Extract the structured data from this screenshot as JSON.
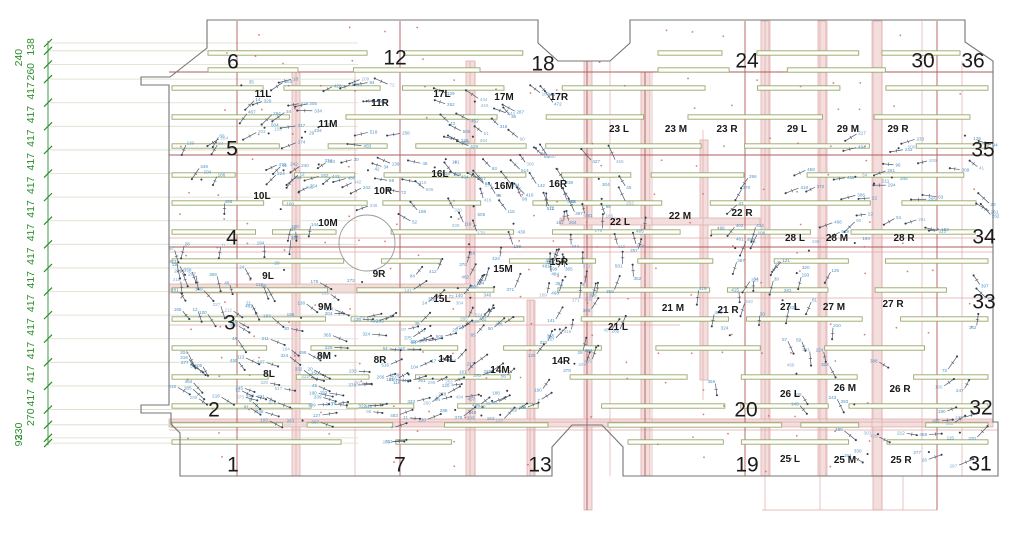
{
  "canvas": {
    "width": 1024,
    "height": 541,
    "background": "#ffffff"
  },
  "colors": {
    "outline": "#757575",
    "outline_light": "#9a9a9a",
    "grid_major": "#b25b5b",
    "grid_minor": "#e2aaaa",
    "band_fill": "#f3dddd",
    "band_edge": "#dca6a6",
    "beam_edge": "#9aa76b",
    "beam_fill": "#fdfefa",
    "dim_green": "#2f8f2f",
    "dim_extension": "#d8dec8",
    "point_line": "#4e596b",
    "point_dot": "#333f4e",
    "point_value": "#4f93c6",
    "point_value_alt": "#85afd3",
    "red_dot": "#d05f5f",
    "label_black": "#1a1a1a",
    "circle": "#9a9a9a"
  },
  "dimension_chain": {
    "axis_x": 48,
    "top_y": 43,
    "scale": 0.0566,
    "label_x": 34,
    "ext_x2": 358,
    "values": [
      "138",
      "240",
      "260",
      "417",
      "417",
      "417",
      "417",
      "417",
      "417",
      "417",
      "417",
      "417",
      "417",
      "417",
      "417",
      "417",
      "417",
      "270",
      "230",
      "93"
    ]
  },
  "grid_numbers": [
    {
      "t": "6",
      "x": 233,
      "y": 63
    },
    {
      "t": "12",
      "x": 395,
      "y": 59
    },
    {
      "t": "18",
      "x": 543,
      "y": 65
    },
    {
      "t": "24",
      "x": 747,
      "y": 62
    },
    {
      "t": "30",
      "x": 923,
      "y": 62
    },
    {
      "t": "36",
      "x": 973,
      "y": 62
    },
    {
      "t": "5",
      "x": 232,
      "y": 150
    },
    {
      "t": "35",
      "x": 983,
      "y": 151
    },
    {
      "t": "4",
      "x": 232,
      "y": 239
    },
    {
      "t": "34",
      "x": 984,
      "y": 238
    },
    {
      "t": "3",
      "x": 230,
      "y": 324
    },
    {
      "t": "33",
      "x": 984,
      "y": 303
    },
    {
      "t": "2",
      "x": 214,
      "y": 411
    },
    {
      "t": "20",
      "x": 746,
      "y": 411
    },
    {
      "t": "32",
      "x": 981,
      "y": 409
    },
    {
      "t": "1",
      "x": 233,
      "y": 466
    },
    {
      "t": "7",
      "x": 400,
      "y": 466
    },
    {
      "t": "13",
      "x": 540,
      "y": 466
    },
    {
      "t": "19",
      "x": 747,
      "y": 466
    },
    {
      "t": "31",
      "x": 980,
      "y": 465
    }
  ],
  "zone_labels": [
    {
      "t": "11L",
      "x": 263,
      "y": 97
    },
    {
      "t": "11M",
      "x": 328,
      "y": 127
    },
    {
      "t": "11R",
      "x": 380,
      "y": 106
    },
    {
      "t": "17L",
      "x": 442,
      "y": 97
    },
    {
      "t": "17M",
      "x": 504,
      "y": 100
    },
    {
      "t": "17R",
      "x": 559,
      "y": 100
    },
    {
      "t": "23 L",
      "x": 619,
      "y": 132
    },
    {
      "t": "23 M",
      "x": 676,
      "y": 132
    },
    {
      "t": "23 R",
      "x": 727,
      "y": 132
    },
    {
      "t": "29 L",
      "x": 797,
      "y": 132
    },
    {
      "t": "29 M",
      "x": 848,
      "y": 132
    },
    {
      "t": "29 R",
      "x": 898,
      "y": 132
    },
    {
      "t": "10L",
      "x": 262,
      "y": 199
    },
    {
      "t": "10M",
      "x": 328,
      "y": 226
    },
    {
      "t": "10R",
      "x": 383,
      "y": 194
    },
    {
      "t": "16L",
      "x": 440,
      "y": 177
    },
    {
      "t": "16M",
      "x": 504,
      "y": 189
    },
    {
      "t": "16R",
      "x": 558,
      "y": 187
    },
    {
      "t": "22 L",
      "x": 620,
      "y": 225
    },
    {
      "t": "22 M",
      "x": 680,
      "y": 219
    },
    {
      "t": "22 R",
      "x": 742,
      "y": 216
    },
    {
      "t": "28 L",
      "x": 795,
      "y": 241
    },
    {
      "t": "28 M",
      "x": 837,
      "y": 241
    },
    {
      "t": "28 R",
      "x": 904,
      "y": 241
    },
    {
      "t": "9L",
      "x": 268,
      "y": 279
    },
    {
      "t": "9M",
      "x": 325,
      "y": 310
    },
    {
      "t": "9R",
      "x": 379,
      "y": 277
    },
    {
      "t": "15L",
      "x": 442,
      "y": 302
    },
    {
      "t": "15M",
      "x": 503,
      "y": 272
    },
    {
      "t": "15R",
      "x": 559,
      "y": 265
    },
    {
      "t": "21 L",
      "x": 618,
      "y": 330
    },
    {
      "t": "21 M",
      "x": 673,
      "y": 311
    },
    {
      "t": "21 R",
      "x": 728,
      "y": 313
    },
    {
      "t": "27 L",
      "x": 790,
      "y": 310
    },
    {
      "t": "27 M",
      "x": 834,
      "y": 310
    },
    {
      "t": "27 R",
      "x": 893,
      "y": 307
    },
    {
      "t": "8L",
      "x": 269,
      "y": 377
    },
    {
      "t": "8M",
      "x": 324,
      "y": 359
    },
    {
      "t": "8R",
      "x": 380,
      "y": 363
    },
    {
      "t": "14L",
      "x": 447,
      "y": 362
    },
    {
      "t": "14M",
      "x": 500,
      "y": 373
    },
    {
      "t": "14R",
      "x": 561,
      "y": 364
    },
    {
      "t": "26 L",
      "x": 790,
      "y": 397
    },
    {
      "t": "26 M",
      "x": 845,
      "y": 391
    },
    {
      "t": "26 R",
      "x": 900,
      "y": 392
    },
    {
      "t": "25 L",
      "x": 790,
      "y": 462
    },
    {
      "t": "25 M",
      "x": 845,
      "y": 463
    },
    {
      "t": "25 R",
      "x": 901,
      "y": 463
    }
  ],
  "outline_polygon": [
    [
      207,
      20
    ],
    [
      538,
      20
    ],
    [
      538,
      43
    ],
    [
      558,
      61
    ],
    [
      610,
      61
    ],
    [
      630,
      43
    ],
    [
      630,
      20
    ],
    [
      965,
      20
    ],
    [
      965,
      42
    ],
    [
      993,
      61
    ],
    [
      993,
      422
    ],
    [
      998,
      422
    ],
    [
      998,
      476
    ],
    [
      623,
      476
    ],
    [
      623,
      447
    ],
    [
      602,
      425
    ],
    [
      572,
      425
    ],
    [
      552,
      447
    ],
    [
      552,
      476
    ],
    [
      180,
      476
    ],
    [
      180,
      433
    ],
    [
      171,
      424
    ],
    [
      171,
      413
    ],
    [
      141,
      413
    ],
    [
      141,
      405
    ],
    [
      169,
      405
    ],
    [
      169,
      85
    ],
    [
      141,
      85
    ],
    [
      141,
      77
    ],
    [
      170,
      77
    ],
    [
      207,
      48
    ]
  ],
  "grid_lines": {
    "vertical_major": [
      {
        "x": 237,
        "y1": 21,
        "y2": 476
      },
      {
        "x": 400,
        "y1": 21,
        "y2": 476
      },
      {
        "x": 587,
        "y1": 61,
        "y2": 510
      },
      {
        "x": 645,
        "y1": 72,
        "y2": 476
      },
      {
        "x": 745,
        "y1": 21,
        "y2": 476
      },
      {
        "x": 937,
        "y1": 21,
        "y2": 510
      }
    ],
    "vertical_minor": [
      {
        "x": 296,
        "y1": 72,
        "y2": 476
      },
      {
        "x": 355,
        "y1": 72,
        "y2": 476
      },
      {
        "x": 470,
        "y1": 61,
        "y2": 476
      },
      {
        "x": 475,
        "y1": 61,
        "y2": 476
      },
      {
        "x": 530,
        "y1": 300,
        "y2": 476
      },
      {
        "x": 535,
        "y1": 300,
        "y2": 476
      },
      {
        "x": 610,
        "y1": 61,
        "y2": 476
      },
      {
        "x": 652,
        "y1": 72,
        "y2": 476
      },
      {
        "x": 703,
        "y1": 130,
        "y2": 400
      },
      {
        "x": 765,
        "y1": 21,
        "y2": 510
      },
      {
        "x": 770,
        "y1": 21,
        "y2": 476
      },
      {
        "x": 820,
        "y1": 21,
        "y2": 510
      },
      {
        "x": 827,
        "y1": 21,
        "y2": 476
      },
      {
        "x": 872,
        "y1": 21,
        "y2": 476
      },
      {
        "x": 882,
        "y1": 21,
        "y2": 510
      },
      {
        "x": 903,
        "y1": 476,
        "y2": 510
      },
      {
        "x": 922,
        "y1": 21,
        "y2": 476
      },
      {
        "x": 962,
        "y1": 61,
        "y2": 476
      }
    ],
    "horizontal_major": [
      {
        "y": 72,
        "x1": 169,
        "x2": 993
      },
      {
        "y": 155,
        "x1": 169,
        "x2": 993
      },
      {
        "y": 247,
        "x1": 169,
        "x2": 993
      }
    ],
    "horizontal_minor": [
      {
        "y": 238,
        "x1": 169,
        "x2": 993
      },
      {
        "y": 252,
        "x1": 169,
        "x2": 993
      },
      {
        "y": 298,
        "x1": 430,
        "x2": 993
      },
      {
        "y": 325,
        "x1": 169,
        "x2": 680
      },
      {
        "y": 422,
        "x1": 169,
        "x2": 998
      },
      {
        "y": 430,
        "x1": 169,
        "x2": 998
      },
      {
        "y": 510,
        "x1": 762,
        "x2": 937
      }
    ]
  },
  "bands": {
    "vertical": [
      {
        "x": 292,
        "w": 8,
        "y1": 72,
        "y2": 476
      },
      {
        "x": 466,
        "w": 9,
        "y1": 61,
        "y2": 476
      },
      {
        "x": 584,
        "w": 8,
        "y1": 61,
        "y2": 510
      },
      {
        "x": 641,
        "w": 9,
        "y1": 72,
        "y2": 476
      },
      {
        "x": 700,
        "w": 8,
        "y1": 140,
        "y2": 380
      },
      {
        "x": 761,
        "w": 8,
        "y1": 21,
        "y2": 476
      },
      {
        "x": 818,
        "w": 8,
        "y1": 21,
        "y2": 476
      },
      {
        "x": 873,
        "w": 9,
        "y1": 21,
        "y2": 510
      },
      {
        "x": 527,
        "w": 7,
        "y1": 300,
        "y2": 476
      }
    ],
    "horizontal": [
      {
        "y": 284,
        "h": 9,
        "x1": 169,
        "x2": 470
      },
      {
        "y": 419,
        "h": 8,
        "x1": 169,
        "x2": 993
      },
      {
        "y": 218,
        "h": 7,
        "x1": 560,
        "x2": 760
      }
    ]
  },
  "core_circle": {
    "cx": 367,
    "cy": 243,
    "r": 28
  },
  "beam_rows": [
    {
      "y": 53,
      "ranges": [
        [
          208,
          536
        ],
        [
          658,
          960
        ]
      ]
    },
    {
      "y": 70,
      "ranges": [
        [
          208,
          536
        ],
        [
          658,
          960
        ]
      ]
    },
    {
      "y": 88,
      "ranges": [
        [
          172,
          988
        ]
      ]
    },
    {
      "y": 117,
      "ranges": [
        [
          172,
          988
        ]
      ]
    },
    {
      "y": 146,
      "ranges": [
        [
          172,
          988
        ]
      ]
    },
    {
      "y": 175,
      "ranges": [
        [
          172,
          988
        ]
      ]
    },
    {
      "y": 203,
      "ranges": [
        [
          172,
          988
        ]
      ]
    },
    {
      "y": 232,
      "ranges": [
        [
          172,
          988
        ]
      ]
    },
    {
      "y": 261,
      "ranges": [
        [
          172,
          988
        ]
      ]
    },
    {
      "y": 290,
      "ranges": [
        [
          172,
          988
        ]
      ]
    },
    {
      "y": 319,
      "ranges": [
        [
          172,
          988
        ]
      ]
    },
    {
      "y": 348,
      "ranges": [
        [
          172,
          988
        ]
      ]
    },
    {
      "y": 377,
      "ranges": [
        [
          172,
          988
        ]
      ]
    },
    {
      "y": 406,
      "ranges": [
        [
          172,
          988
        ]
      ]
    },
    {
      "y": 425,
      "ranges": [
        [
          172,
          548
        ],
        [
          608,
          988
        ]
      ]
    },
    {
      "y": 442,
      "ranges": [
        [
          172,
          548
        ],
        [
          628,
          988
        ]
      ]
    }
  ],
  "point_field": {
    "seed": 1337,
    "value_min": 4,
    "value_max": 520,
    "fields": [
      {
        "cx": 367,
        "cy": 243,
        "rmin": 33,
        "rmax": 215,
        "xscale": 1.32,
        "yscale": 0.94,
        "count": 455,
        "xmin": 176,
        "xmax": 758,
        "ymin": 80,
        "ymax": 462
      },
      {
        "cx": 915,
        "cy": 330,
        "rmin": 35,
        "rmax": 228,
        "xscale": 1.0,
        "yscale": 1.0,
        "count": 190,
        "xmin": 662,
        "xmax": 988,
        "ymin": 134,
        "ymax": 464
      }
    ],
    "exclusions": [
      {
        "x": 640,
        "y": 21,
        "w": 353,
        "h": 108,
        "keep": 0.0
      },
      {
        "x": 169,
        "y": 21,
        "w": 70,
        "h": 230,
        "keep": 0.3
      },
      {
        "x": 590,
        "y": 385,
        "w": 170,
        "h": 80,
        "keep": 0.25
      }
    ]
  },
  "red_dots": {
    "seed": 77,
    "x0": 186,
    "x1": 985,
    "dx": 34,
    "y0": 32,
    "y1": 466,
    "dy": 27,
    "jitter": 8,
    "keep": 0.55
  }
}
